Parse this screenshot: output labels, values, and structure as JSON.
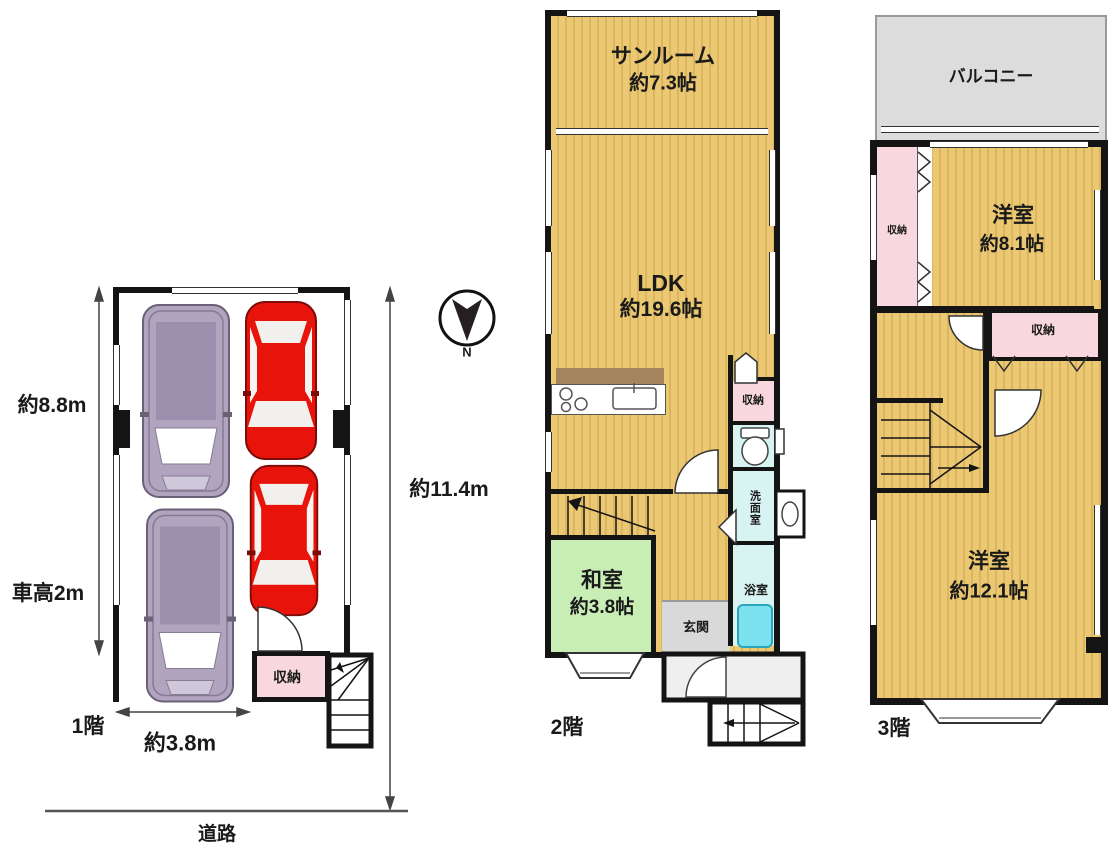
{
  "colors": {
    "tatami_yellow": "#ebc873",
    "tatami_stripe": "#dcb55c",
    "washitsu_green": "#c9eeb5",
    "storage_pink": "#f8d7de",
    "wet_room_cyan": "#d8f4f2",
    "bathtub_cyan": "#7de2ef",
    "balcony_gray": "#dcdcdc",
    "genkan_gray": "#d9d9d9",
    "wall_black": "#141414",
    "car_red": "#e8140c",
    "van_purple": "#b0a4bf"
  },
  "floor1": {
    "label": "1階",
    "width_label": "約3.8m",
    "height_label": "約8.8m",
    "car_height_label": "車高2m",
    "storage_label": "収納",
    "road_label": "道路",
    "total_depth_label": "約11.4m",
    "compass_label": "N"
  },
  "floor2": {
    "label": "2階",
    "sunroom": {
      "name": "サンルーム",
      "size": "約7.3帖"
    },
    "ldk": {
      "name": "LDK",
      "size": "約19.6帖"
    },
    "washitsu": {
      "name": "和室",
      "size": "約3.8帖"
    },
    "genkan_label": "玄関",
    "storage_label": "収納",
    "washroom_label": "洗面室",
    "bathroom_label": "浴室"
  },
  "floor3": {
    "label": "3階",
    "balcony_label": "バルコニー",
    "bedroom1": {
      "name": "洋室",
      "size": "約8.1帖"
    },
    "bedroom2": {
      "name": "洋室",
      "size": "約12.1帖"
    },
    "storage_left_label": "収納",
    "storage_mid_label": "収納"
  }
}
